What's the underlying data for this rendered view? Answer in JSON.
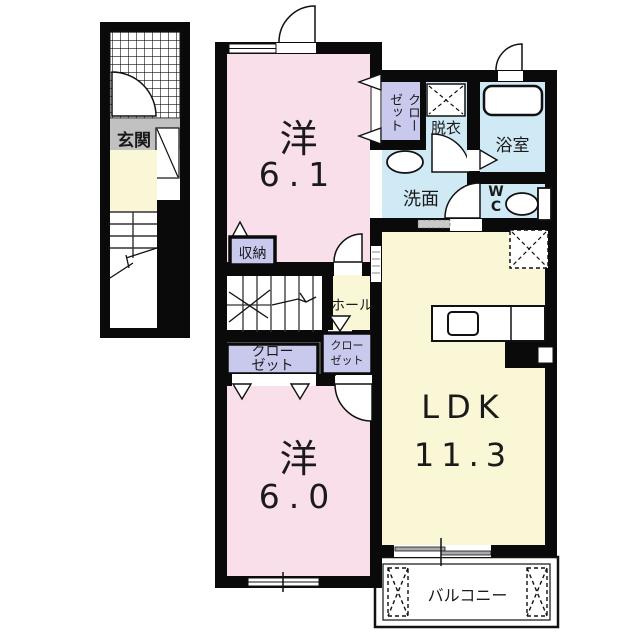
{
  "plan_title": "apartment-floor-plan",
  "colors": {
    "wall": "#0a0a0a",
    "room_pink": "#f9dfea",
    "room_cream": "#faf7d6",
    "room_lavender": "#c9c9ee",
    "room_blue": "#cfe9f5",
    "entrance_gray": "#c1c1c1"
  },
  "left_building": {
    "entrance": {
      "label": "玄関"
    }
  },
  "rooms": {
    "yo61": {
      "name": "洋",
      "size": "6.1"
    },
    "closet61": {
      "label": "クローゼット",
      "line1": "クロー",
      "line2": "ゼット"
    },
    "datsui": {
      "label": "脱衣"
    },
    "bath": {
      "label": "浴室"
    },
    "senmen": {
      "label": "洗面"
    },
    "wc": {
      "line1": "W",
      "line2": "C"
    },
    "hall": {
      "label": "ホール"
    },
    "shuno": {
      "label": "収納"
    },
    "closet60": {
      "label": "クローゼット",
      "line1": "クロー",
      "line2": "ゼット"
    },
    "closet_hall": {
      "label": "クローゼット",
      "line1": "クロー",
      "line2": "ゼット"
    },
    "yo60": {
      "name": "洋",
      "size": "6.0"
    },
    "ldk": {
      "name": "LDK",
      "size": "11.3"
    },
    "balcony": {
      "label": "バルコニー"
    }
  }
}
